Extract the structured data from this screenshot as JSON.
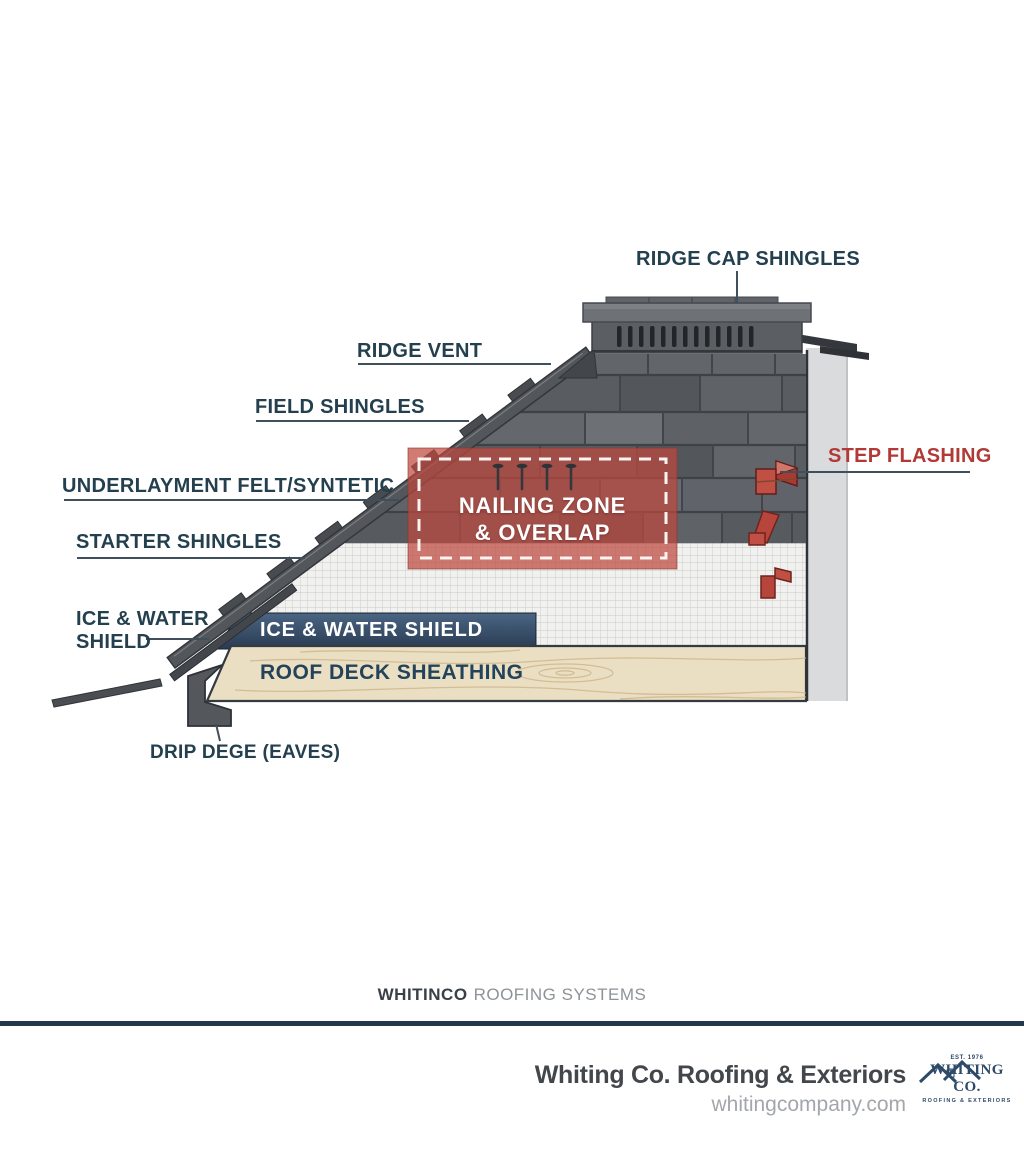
{
  "diagram": {
    "labels": {
      "ridge_cap": "RIDGE CAP SHINGLES",
      "ridge_vent": "RIDGE VENT",
      "field_shingles": "FIELD SHINGLES",
      "underlayment": "UNDERLAYMENT FELT/SYNTETIC",
      "starter_shingles": "STARTER SHINGLES",
      "ice_water_line1": "ICE & WATER",
      "ice_water_line2": "SHIELD",
      "drip_edge": "DRIP DEGE (EAVES)",
      "step_flashing": "STEP FLASHING",
      "nailing_line1": "NAILING ZONE",
      "nailing_line2": "& OVERLAP",
      "ice_water_banner": "ICE & WATER SHIELD",
      "roof_deck": "ROOF DECK SHEATHING"
    },
    "colors": {
      "label_navy": "#24404f",
      "accent_red": "#b23a36",
      "nailing_fill": "#c2584c",
      "banner_navy": "#32496b",
      "shingle_gray": "#5d6166",
      "wood_tan": "#ebdfc3",
      "divider_navy": "#22384d",
      "logo_navy": "#2d4a68"
    }
  },
  "footer": {
    "brand": "WHITINCO",
    "suffix": "ROOFING SYSTEMS"
  },
  "brandbar": {
    "company": "Whiting Co. Roofing & Exteriors",
    "website": "whitingcompany.com",
    "logo": {
      "est": "EST. 1976",
      "name": "WHITING CO.",
      "sub": "ROOFING & EXTERIORS"
    }
  }
}
